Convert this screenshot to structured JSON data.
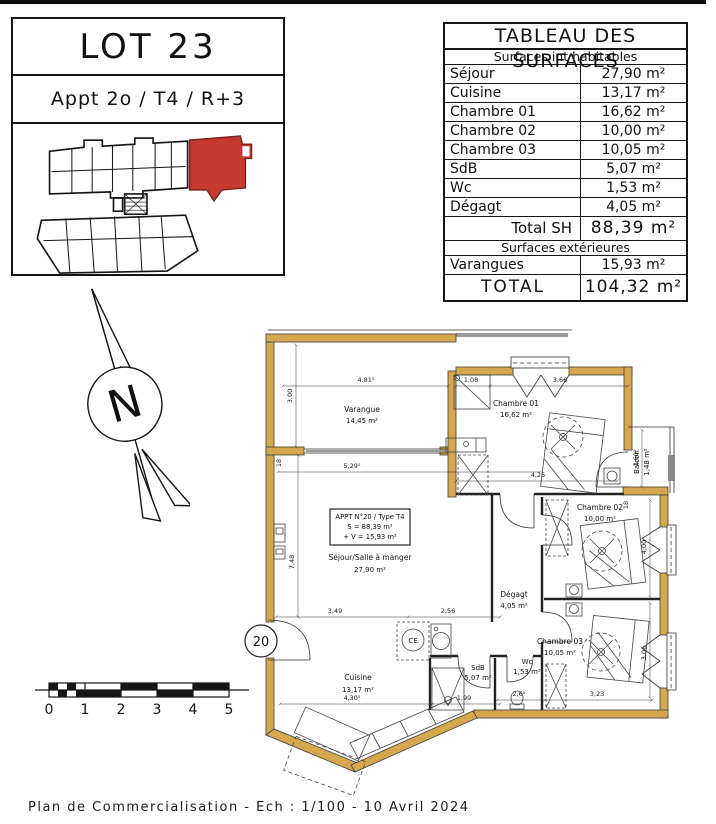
{
  "header": {
    "lot_title": "LOT 23",
    "appt_subtitle": "Appt 2o / T4 / R+3"
  },
  "surfaces_table": {
    "title": "TABLEAU DES SURFACES",
    "interior_header": "Surfaces int habitables",
    "rows": [
      {
        "label": "Séjour",
        "value": "27,90 m²"
      },
      {
        "label": "Cuisine",
        "value": "13,17 m²"
      },
      {
        "label": "Chambre 01",
        "value": "16,62 m²"
      },
      {
        "label": "Chambre 02",
        "value": "10,00 m²"
      },
      {
        "label": "Chambre 03",
        "value": "10,05 m²"
      },
      {
        "label": "SdB",
        "value": "5,07 m²"
      },
      {
        "label": "Wc",
        "value": "1,53 m²"
      },
      {
        "label": "Dégagt",
        "value": "4,05 m²"
      }
    ],
    "total_sh_label": "Total SH",
    "total_sh_value": "88,39 m²",
    "exterior_header": "Surfaces extérieures",
    "exterior_rows": [
      {
        "label": "Varangues",
        "value": "15,93 m²"
      }
    ],
    "total_label": "TOTAL",
    "total_value": "104,32 m²"
  },
  "compass": {
    "letter": "N"
  },
  "scale_bar": {
    "labels": [
      "0",
      "1",
      "2",
      "3",
      "4",
      "5"
    ]
  },
  "plan": {
    "apt_box": {
      "line1": "APPT N°20 / Type T4",
      "line2": "S = 88,39 m²",
      "line3": "+ V = 15,93 m²"
    },
    "entrance_label": "20",
    "ce_label": "CE",
    "rooms": {
      "varangue": {
        "name": "Varangue",
        "area": "14,45 m²"
      },
      "sejour": {
        "name": "Séjour/Salle à manger",
        "area": "27,90 m²"
      },
      "chambre01": {
        "name": "Chambre 01",
        "area": "16,62 m²"
      },
      "chambre02": {
        "name": "Chambre 02",
        "area": "10,00 m²"
      },
      "chambre03": {
        "name": "Chambre 03",
        "area": "10,05 m²"
      },
      "balcon": {
        "name": "Balcon",
        "area": "1,48 m²"
      },
      "degagt": {
        "name": "Dégagt",
        "area": "4,05 m²"
      },
      "wc": {
        "name": "Wc",
        "area": "1,53 m²"
      },
      "sdb": {
        "name": "SdB",
        "area": "5,07 m²"
      },
      "cuisine": {
        "name": "Cuisine",
        "area": "13,17 m²"
      }
    },
    "dims": {
      "varangue_w": "4,81⁵",
      "varangue_h": "3,00",
      "closet": "1,08",
      "ch01_w": "3,66",
      "ch01_inner": "4,25",
      "sejour_w": "5,29⁵",
      "sejour_h": "7,48",
      "kitchen_a": "3,49",
      "kitchen_b": "2,56",
      "kitchen_c": "4,30⁵",
      "sdb_w": "1,99",
      "wc_w": "2,6⁵",
      "ch03_w": "3,23",
      "ch02_h": "4,00",
      "ch03_h": "3,06",
      "balcon_h": "1,60⁵",
      "wall_a": "18",
      "wall_b": "18"
    }
  },
  "footer": {
    "text": "Plan de Commercialisation - Ech : 1/100 - 10 Avril 2024"
  }
}
